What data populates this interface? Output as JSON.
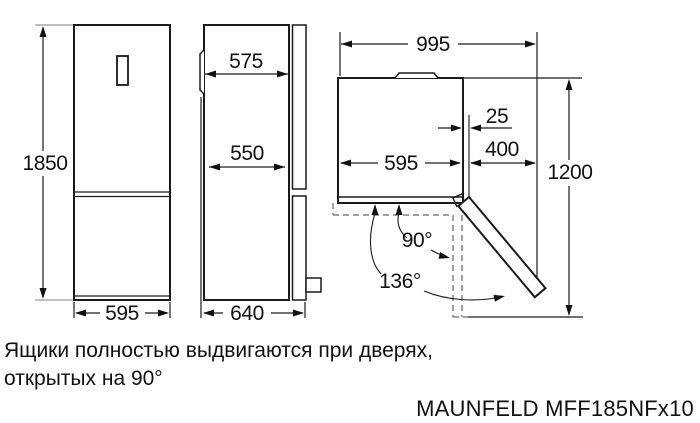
{
  "dims": {
    "front": {
      "height": "1850",
      "width": "595"
    },
    "side": {
      "depth": "575",
      "inner_depth": "550",
      "total_depth": "640"
    },
    "top": {
      "total_width": "995",
      "gap": "25",
      "width": "595",
      "clearance": "400",
      "depth_open": "1200",
      "angle_main": "90°",
      "angle_max": "136°"
    }
  },
  "caption": {
    "line1": "Ящики полностью выдвигаются при дверях,",
    "line2": "открытых на 90°"
  },
  "brand": "MAUNFELD MFF185NFx10",
  "colors": {
    "line": "#1a1a1a",
    "extension": "#9a9a9a",
    "dashed": "#666666",
    "background": "#ffffff"
  }
}
